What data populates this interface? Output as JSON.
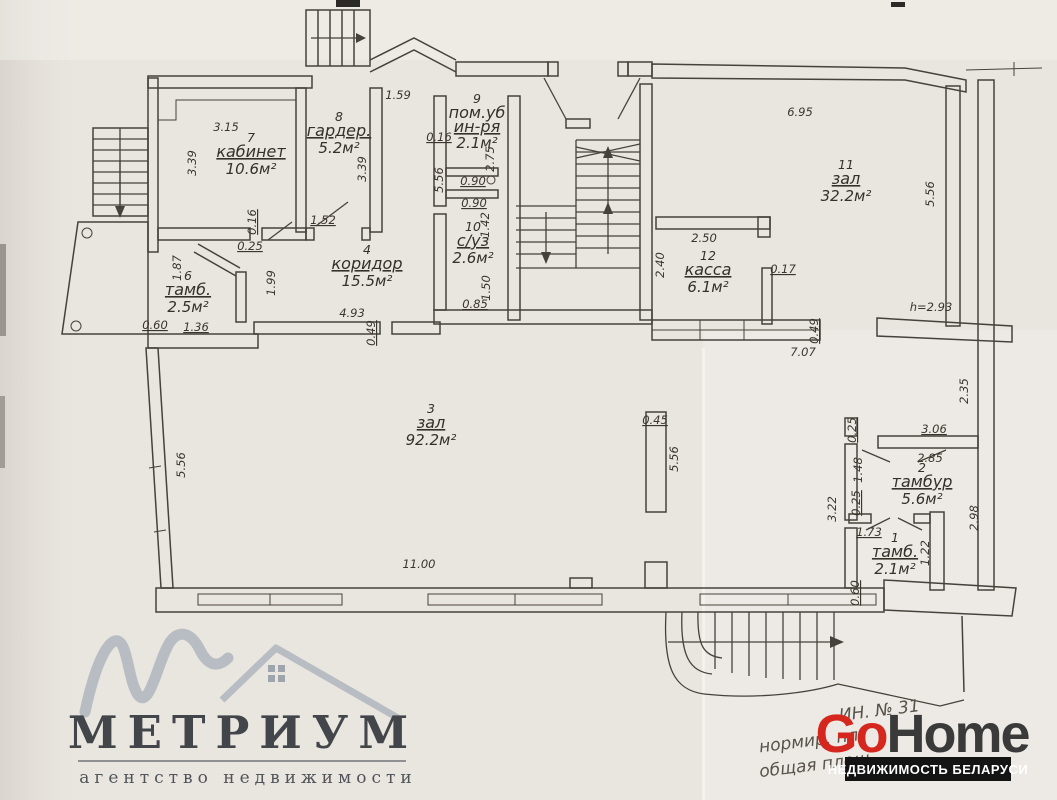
{
  "document": {
    "kind": "scanned floor plan",
    "paper_color": "#e9e5df",
    "ink_color": "#46423b"
  },
  "rooms": [
    {
      "number": "7",
      "name": "кабинет",
      "area": "10.6м²",
      "x": 251,
      "y": 142
    },
    {
      "number": "8",
      "name": "гардер.",
      "area": "5.2м²",
      "x": 339,
      "y": 121
    },
    {
      "number": "9",
      "name": "пом.уб",
      "name2": "ин-ря",
      "area": "2.1м²",
      "x": 477,
      "y": 103
    },
    {
      "number": "10",
      "name": "с/уз",
      "area": "2.6м²",
      "x": 473,
      "y": 231
    },
    {
      "number": "6",
      "name": "тамб.",
      "area": "2.5м²",
      "x": 188,
      "y": 280
    },
    {
      "number": "4",
      "name": "коридор",
      "area": "15.5м²",
      "x": 367,
      "y": 254
    },
    {
      "number": "3",
      "name": "зал",
      "area": "92.2м²",
      "x": 431,
      "y": 413
    },
    {
      "number": "11",
      "name": "зал",
      "area": "32.2м²",
      "x": 846,
      "y": 169
    },
    {
      "number": "12",
      "name": "касса",
      "area": "6.1м²",
      "x": 708,
      "y": 260
    },
    {
      "number": "2",
      "name": "тамбур",
      "area": "5.6м²",
      "x": 922,
      "y": 472
    },
    {
      "number": "1",
      "name": "тамб.",
      "area": "2.1м²",
      "x": 895,
      "y": 542
    }
  ],
  "dimensions": [
    {
      "t": "1.59",
      "x": 398,
      "y": 99
    },
    {
      "t": "3.15",
      "x": 226,
      "y": 131
    },
    {
      "t": "3.39",
      "x": 196,
      "y": 163,
      "r": -90
    },
    {
      "t": "3.39",
      "x": 366,
      "y": 169,
      "r": -90
    },
    {
      "t": "1.52",
      "x": 323,
      "y": 224,
      "u": 1
    },
    {
      "t": "0.16",
      "x": 256,
      "y": 222,
      "r": -90,
      "u": 1
    },
    {
      "t": "0.25",
      "x": 250,
      "y": 250,
      "u": 1
    },
    {
      "t": "1.87",
      "x": 181,
      "y": 268,
      "r": -90
    },
    {
      "t": "1.99",
      "x": 275,
      "y": 283,
      "r": -90
    },
    {
      "t": "4.93",
      "x": 352,
      "y": 317
    },
    {
      "t": "0.49",
      "x": 375,
      "y": 333,
      "r": -90,
      "u": 1
    },
    {
      "t": "0.60",
      "x": 155,
      "y": 329,
      "u": 1
    },
    {
      "t": "1.36",
      "x": 196,
      "y": 331,
      "u": 1
    },
    {
      "t": "0.16",
      "x": 439,
      "y": 141,
      "u": 1
    },
    {
      "t": "5.56",
      "x": 443,
      "y": 180,
      "r": -90
    },
    {
      "t": "0.90",
      "x": 473,
      "y": 185,
      "u": 1
    },
    {
      "t": "0.90",
      "x": 474,
      "y": 207,
      "u": 1
    },
    {
      "t": "2.75",
      "x": 494,
      "y": 159,
      "r": -90
    },
    {
      "t": "1.42",
      "x": 489,
      "y": 225,
      "r": -90
    },
    {
      "t": "1.50",
      "x": 490,
      "y": 288,
      "r": -90
    },
    {
      "t": "0.85",
      "x": 475,
      "y": 308,
      "u": 1
    },
    {
      "t": "6.95",
      "x": 800,
      "y": 116
    },
    {
      "t": "5.56",
      "x": 934,
      "y": 194,
      "r": -90
    },
    {
      "t": "2.50",
      "x": 704,
      "y": 242
    },
    {
      "t": "2.40",
      "x": 664,
      "y": 265,
      "r": -90
    },
    {
      "t": "0.17",
      "x": 783,
      "y": 273,
      "u": 1
    },
    {
      "t": "7.07",
      "x": 803,
      "y": 356
    },
    {
      "t": "0.49",
      "x": 818,
      "y": 331,
      "r": -90,
      "u": 1
    },
    {
      "t": "h=2.93",
      "x": 931,
      "y": 311
    },
    {
      "t": "2.35",
      "x": 968,
      "y": 391,
      "r": -90
    },
    {
      "t": "0.45",
      "x": 655,
      "y": 424,
      "u": 1
    },
    {
      "t": "5.56",
      "x": 678,
      "y": 459,
      "r": -90
    },
    {
      "t": "5.56",
      "x": 185,
      "y": 465,
      "r": -90
    },
    {
      "t": "11.00",
      "x": 419,
      "y": 568
    },
    {
      "t": "3.06",
      "x": 934,
      "y": 433,
      "u": 1
    },
    {
      "t": "2.85",
      "x": 930,
      "y": 462
    },
    {
      "t": "1.48",
      "x": 862,
      "y": 470,
      "r": -90
    },
    {
      "t": "0.25",
      "x": 856,
      "y": 430,
      "r": -90,
      "u": 1
    },
    {
      "t": "0.25",
      "x": 860,
      "y": 503,
      "r": -90,
      "u": 1
    },
    {
      "t": "3.22",
      "x": 836,
      "y": 509,
      "r": -90
    },
    {
      "t": "2.98",
      "x": 978,
      "y": 518,
      "r": -90
    },
    {
      "t": "1.73",
      "x": 869,
      "y": 536,
      "u": 1
    },
    {
      "t": "1.22",
      "x": 929,
      "y": 553,
      "r": -90
    },
    {
      "t": "0.60",
      "x": 859,
      "y": 593,
      "r": -90,
      "u": 1
    }
  ],
  "stamp": {
    "line1": "ИН. № 31",
    "line2": "нормир. пл.",
    "line3": "общая площ."
  },
  "watermarks": {
    "metrium": {
      "title": "МЕТРИУМ",
      "tagline": "агентство недвижимости",
      "glyph_color": "#b5bbc2",
      "text_color": "#3a3e44"
    },
    "gohome": {
      "go": "Go",
      "home": "Home",
      "banner": "НЕДВИЖИМОСТЬ БЕЛАРУСИ",
      "go_color": "#d5271d",
      "home_color": "#3a3a3a",
      "banner_bg": "#141414"
    }
  }
}
